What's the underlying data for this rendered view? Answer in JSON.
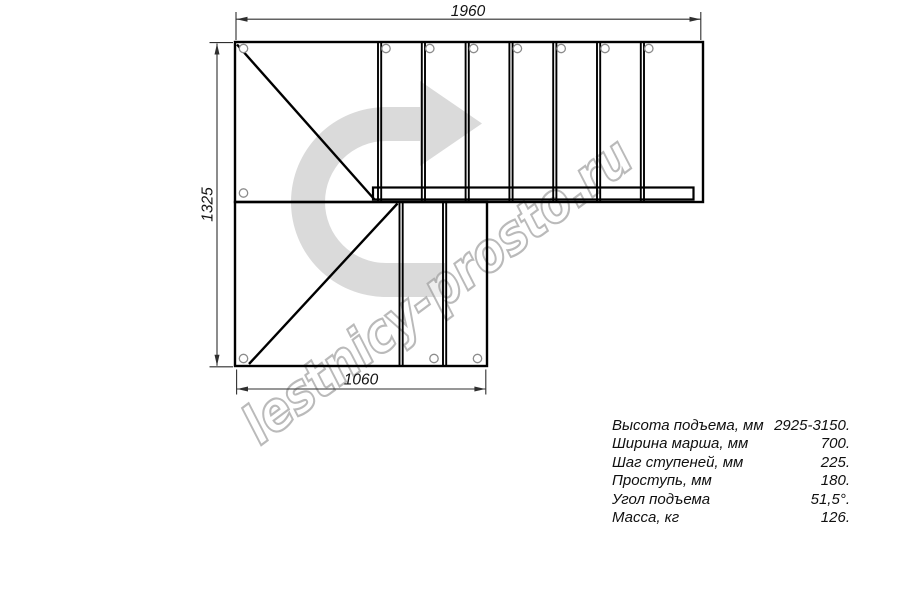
{
  "drawing": {
    "dimensions": {
      "top": "1960",
      "left": "1325",
      "bottom": "1060"
    },
    "watermark": {
      "text": "lestnicy-prosto.ru"
    }
  },
  "specs": {
    "rows": [
      {
        "label": "Высота подъема, мм",
        "value": "2925-3150."
      },
      {
        "label": "Ширина марша, мм",
        "value": "700."
      },
      {
        "label": "Шаг ступеней, мм",
        "value": "225."
      },
      {
        "label": "Проступь, мм",
        "value": "180."
      },
      {
        "label": "Угол подъема",
        "value": "51,5°."
      },
      {
        "label": "Масса, кг",
        "value": "126."
      }
    ]
  },
  "colors": {
    "background": "#ffffff",
    "drawing_line": "#000000",
    "dimension_line": "#2f2f2f",
    "direction_arrow_fill": "#dadada",
    "watermark_outline": "#a0a0a0",
    "watermark_fill": "rgba(255,255,255,0.55)",
    "hole_outline": "#8c8c8c"
  }
}
